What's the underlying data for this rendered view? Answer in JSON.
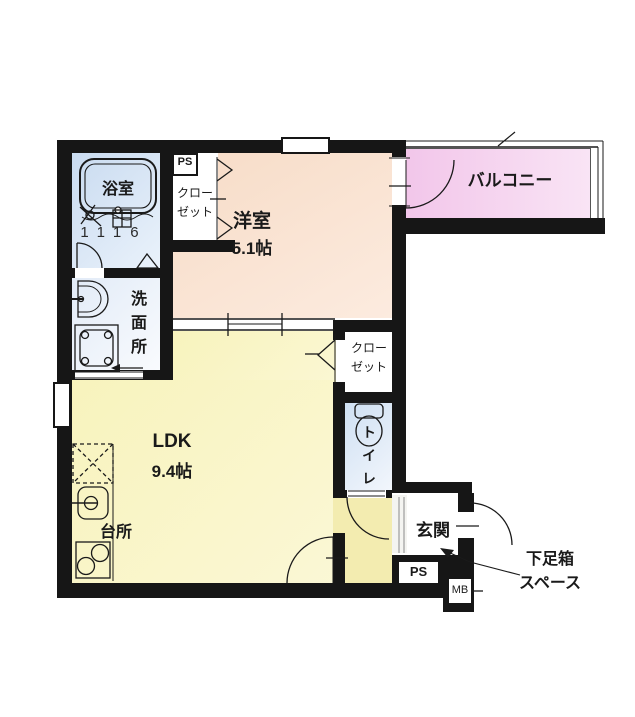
{
  "labels": {
    "bathroom": "浴室",
    "bathtub_size": "1116",
    "ps_upper": "PS",
    "closet_upper_line1": "クロー",
    "closet_upper_line2": "ゼット",
    "western_room": "洋室",
    "western_room_size": "5.1帖",
    "balcony": "バルコニー",
    "washroom": "洗面所",
    "closet_mid_line1": "クロー",
    "closet_mid_line2": "ゼット",
    "toilet": "トイレ",
    "ldk": "LDK",
    "ldk_size": "9.4帖",
    "kitchen": "台所",
    "entrance": "玄関",
    "ps_lower": "PS",
    "mb": "MB",
    "shoebox_line1": "下足箱",
    "shoebox_line2": "スペース"
  },
  "colors": {
    "wall": "#161616",
    "bathroom": "#dbe7f5",
    "washroom": "#e9f0f9",
    "western_room": "#f8dfcc",
    "balcony": "#f4cdec",
    "ldk": "#f9f4c4",
    "hallway": "#f3ecb0",
    "toilet": "#d9e6f5",
    "entrance": "#ffffff"
  }
}
